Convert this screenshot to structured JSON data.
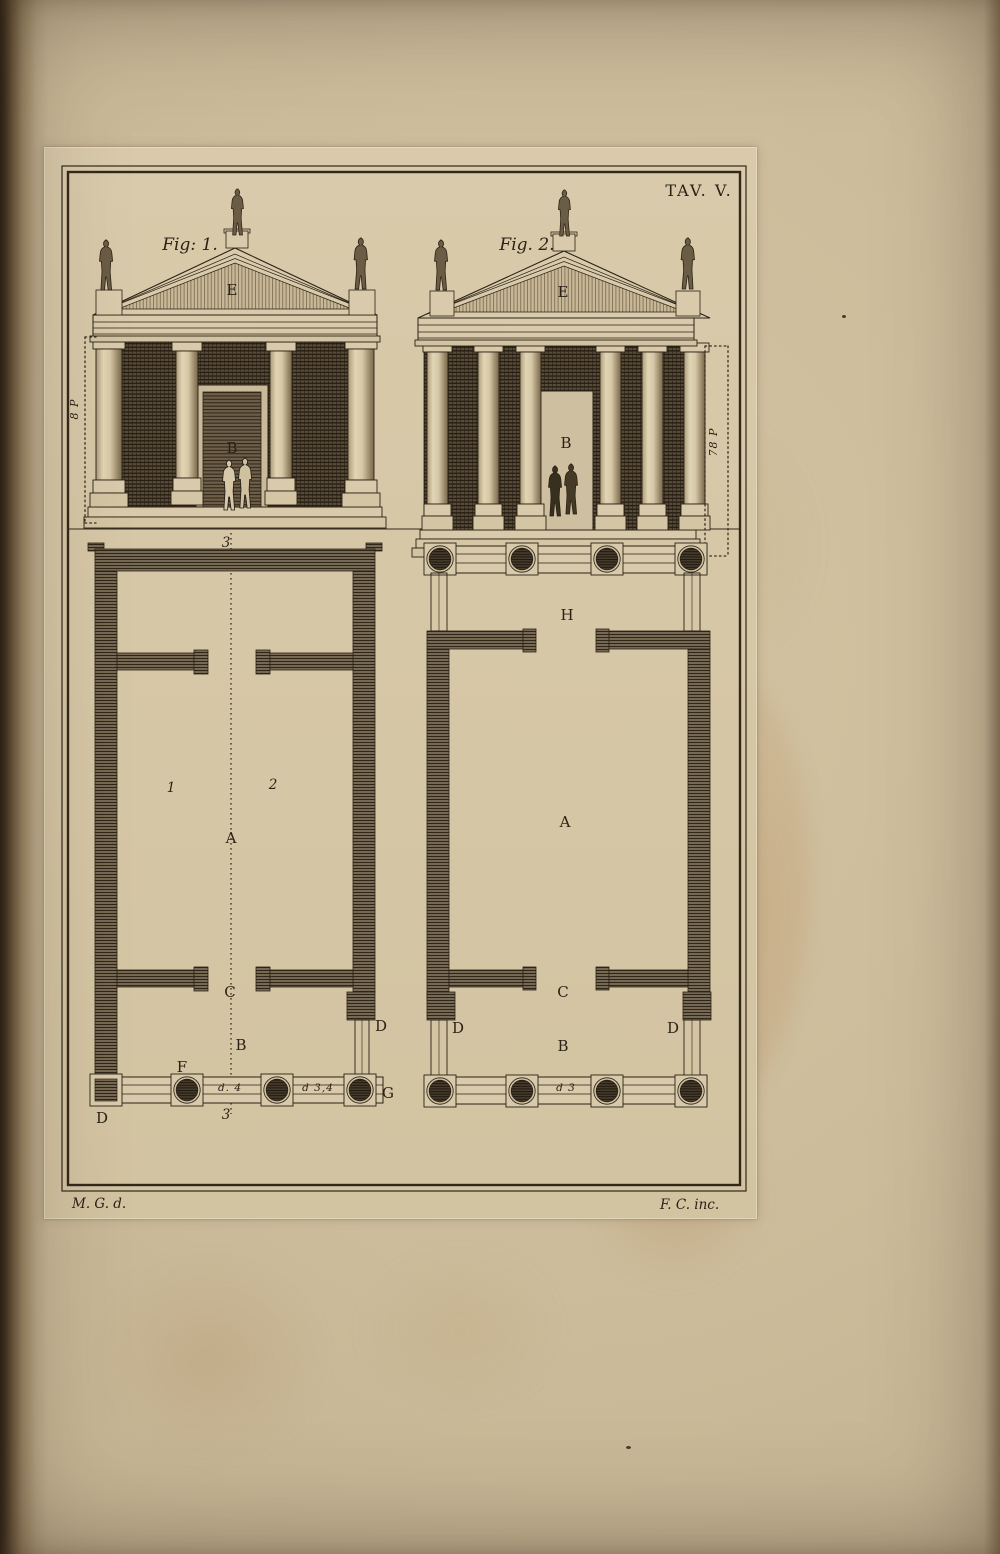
{
  "page": {
    "plate_title": "TAV. V.",
    "credit_delineator": "M. G. d.",
    "credit_engraver": "F. C. inc."
  },
  "fig1": {
    "caption": "Fig: 1.",
    "pediment_label": "E",
    "door_label": "B",
    "height_dimension": "8 P"
  },
  "fig2": {
    "caption": "Fig. 2.",
    "pediment_label": "E",
    "door_label": "B",
    "height_dimension": "78 P"
  },
  "plan1": {
    "axis_top": "3",
    "axis_bottom": "3",
    "cella_left_half": "1",
    "cella_right_half": "2",
    "cella": "A",
    "doorway": "C",
    "pronaos": "B",
    "front_column": "F",
    "corner_column": "G",
    "pier_bottom_left": "D",
    "pier_right": "D",
    "intercolumniation_center": "d. 4",
    "intercolumniation_right": "d 3,4"
  },
  "plan2": {
    "rear_portico": "H",
    "cella": "A",
    "doorway": "C",
    "pronaos": "B",
    "pier_left": "D",
    "pier_right": "D",
    "intercolumniation_center": "d 3"
  },
  "colors": {
    "ink": "#2b2216",
    "paper": "#cdbd9c",
    "plate_paper": "#d8caaa"
  }
}
